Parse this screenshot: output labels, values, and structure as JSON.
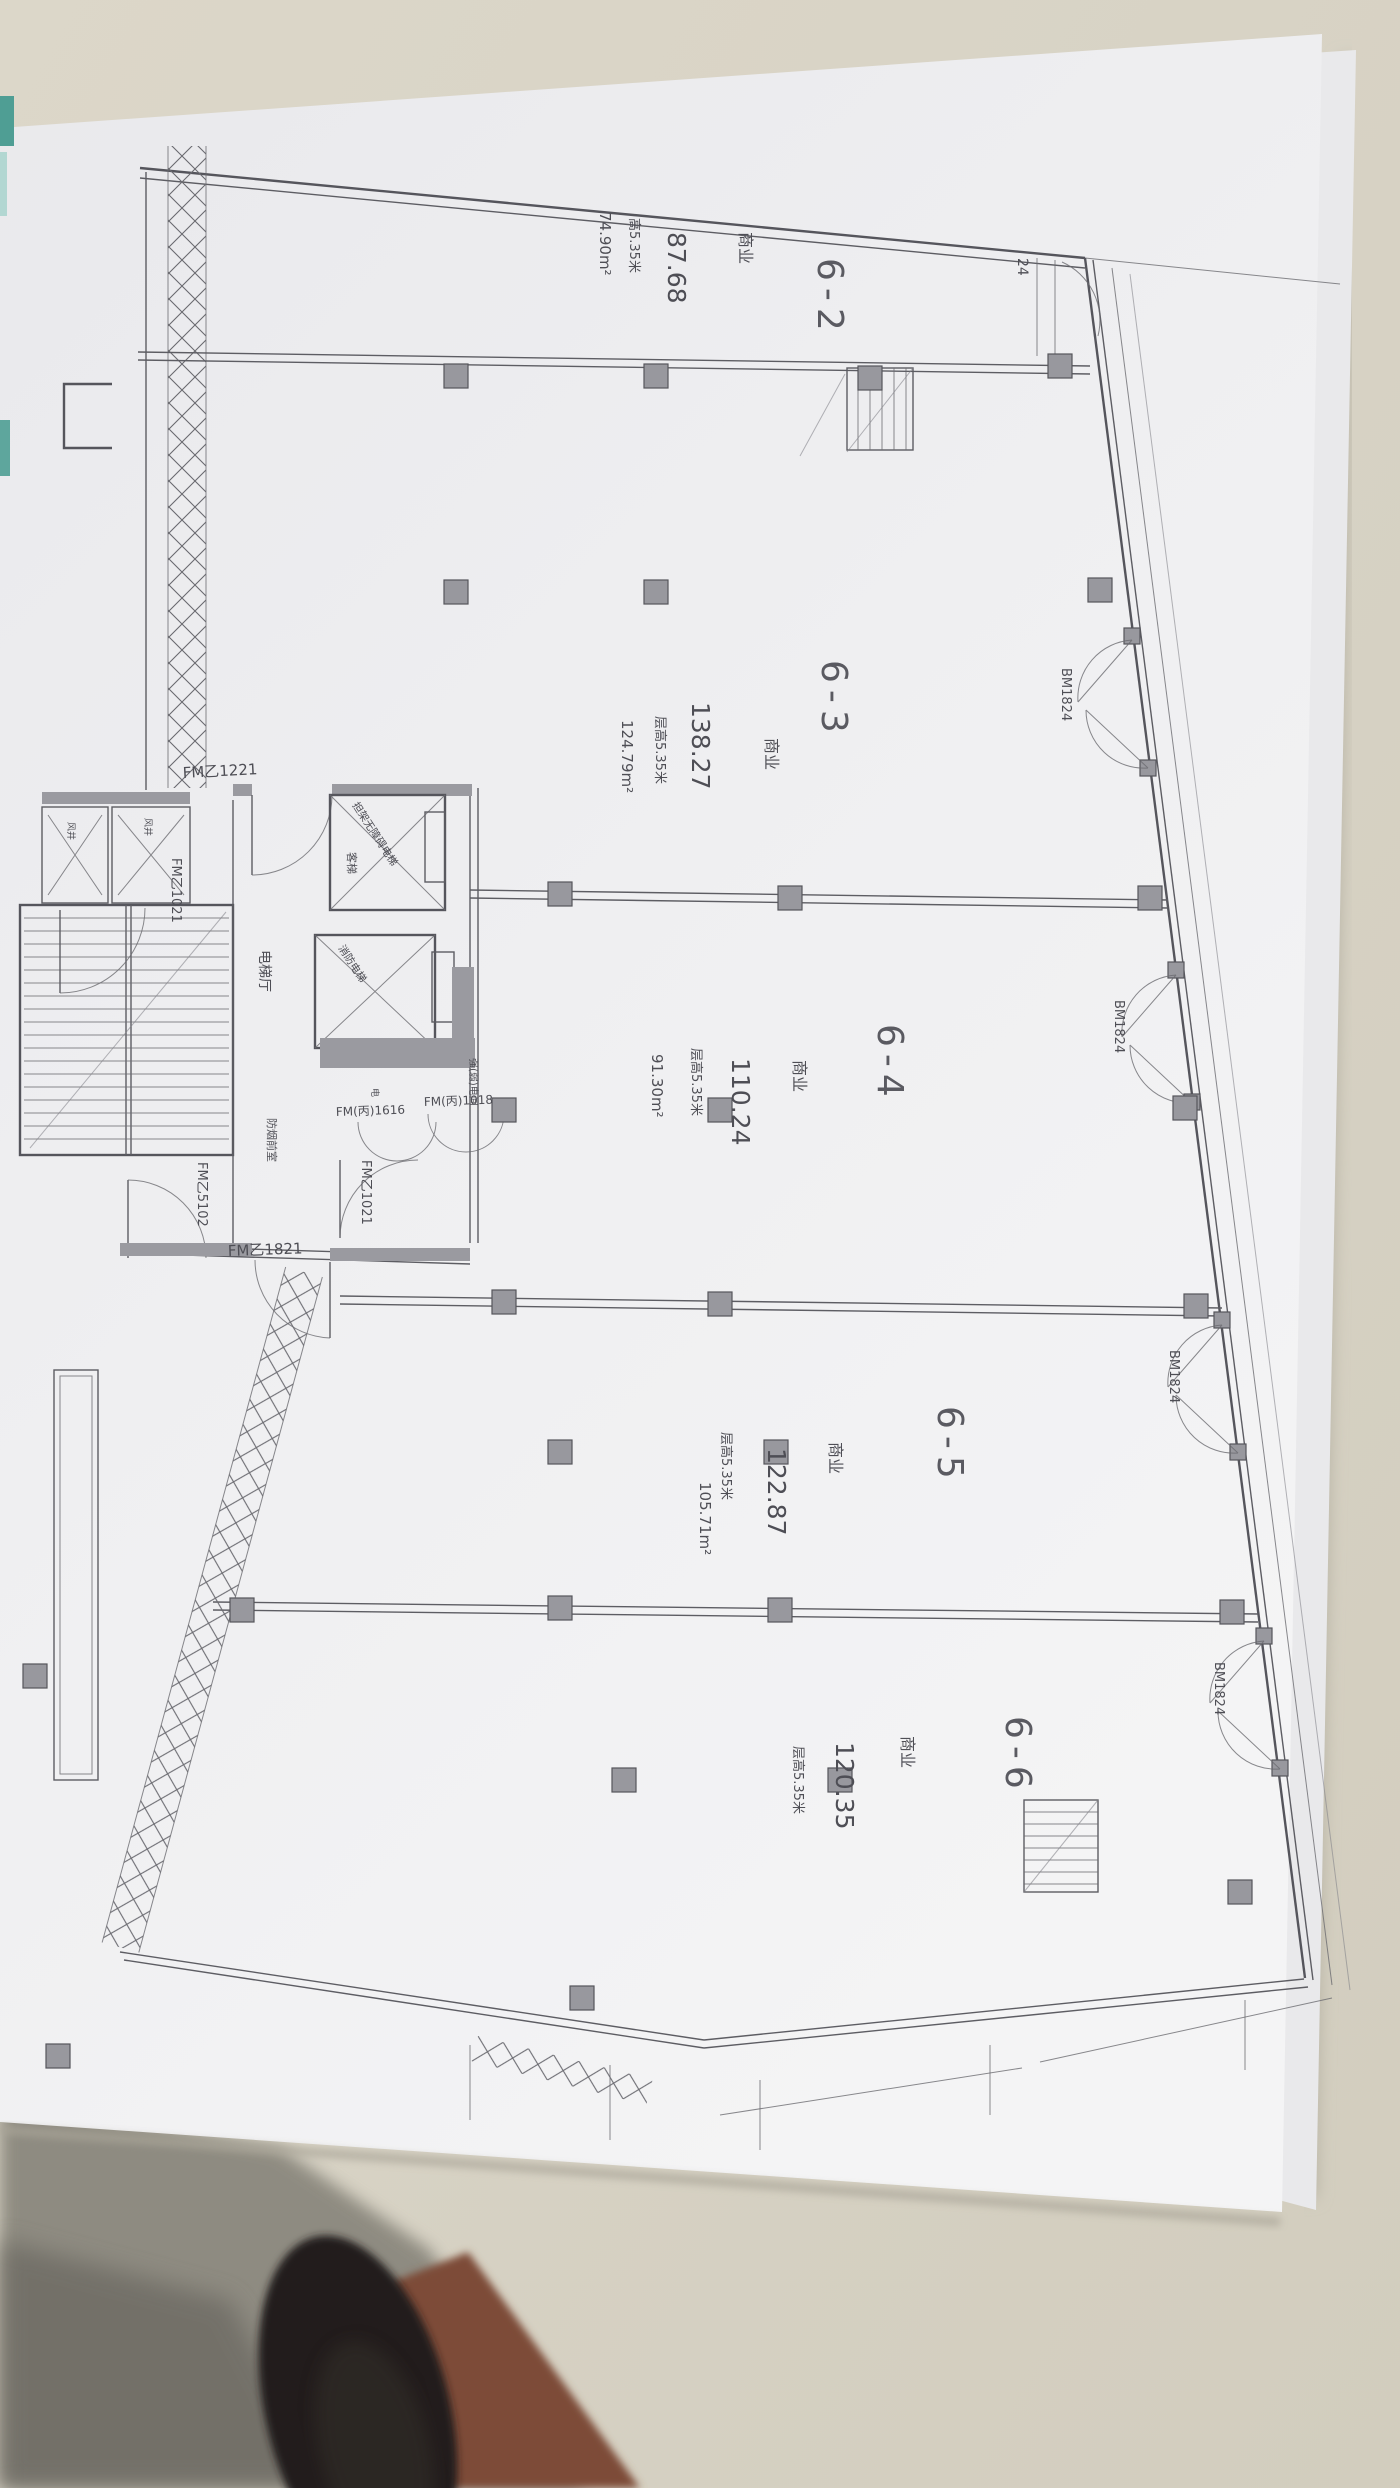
{
  "plan": {
    "units": [
      {
        "label": "6-2",
        "use": "商业",
        "area": "87.68",
        "height": "高5.35米",
        "net": "74.90m²"
      },
      {
        "label": "6-3",
        "use": "商业",
        "area": "138.27",
        "height": "层高5.35米",
        "net": "124.79m²"
      },
      {
        "label": "6-4",
        "use": "商业",
        "area": "110.24",
        "height": "层高5.35米",
        "net": "91.30m²"
      },
      {
        "label": "6-5",
        "use": "商业",
        "area": "122.87",
        "height": "层高5.35米",
        "net": "105.71m²"
      },
      {
        "label": "6-6",
        "use": "商业",
        "area": "120.35",
        "height": "层高5.35米",
        "net": ""
      }
    ],
    "doors": {
      "storefront": "BM1824",
      "storefront_partial": "24",
      "fm1221": "FM乙1221",
      "fm1021": "FM乙1021",
      "fm1821": "FM乙1821",
      "fm5102": "FM乙5102",
      "fmc1616": "FM(丙)1616",
      "fmc1018": "FM(丙)1018"
    },
    "rooms": {
      "elevator_hall": "电梯厅",
      "wind_shaft": "风井",
      "smoke_lobby": "防烟前室",
      "elec_room": "强(弱)电间",
      "elevator1_name": "担架无障碍电梯",
      "elevator1_type": "客梯",
      "elevator2_name": "消防电梯",
      "elec_char": "电"
    }
  },
  "colors": {
    "desk": "#d7d2c4",
    "desk_shadow": "#8b887e",
    "floor": "#7d4c37",
    "shoe": "#211e1c",
    "paper": "#f1f1f3",
    "teal": "#4f9e94",
    "ink": "#54545a",
    "wall_fill": "#98989e"
  }
}
